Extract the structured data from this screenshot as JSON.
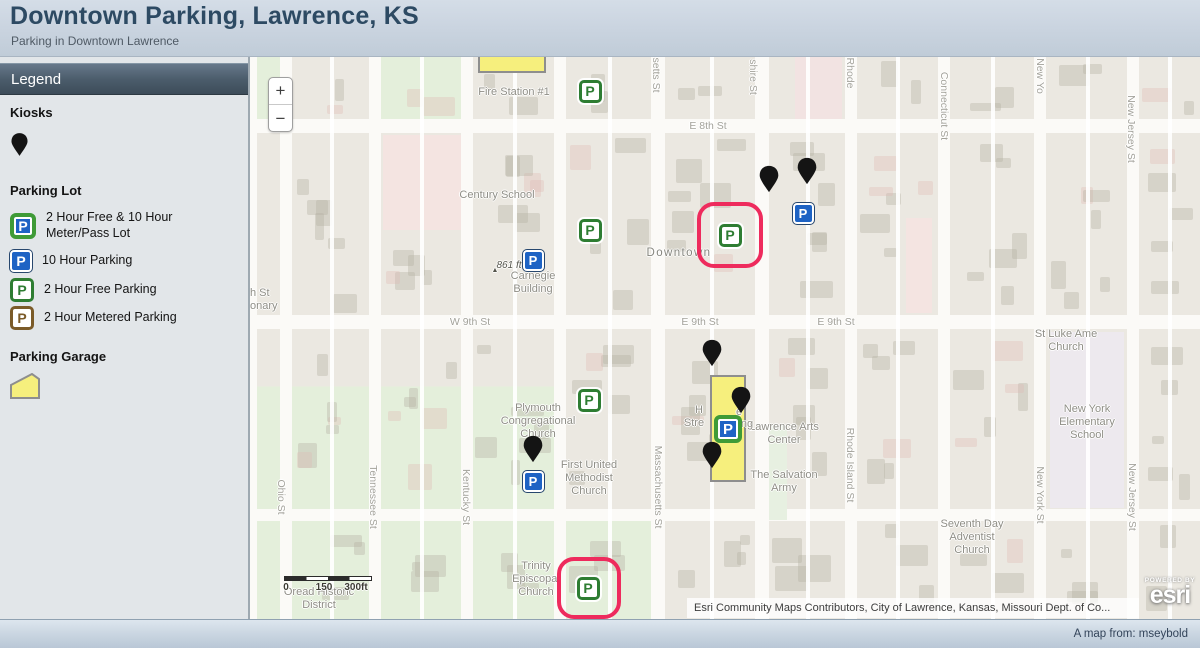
{
  "header": {
    "title": "Downtown Parking, Lawrence, KS",
    "subtitle": "Parking in Downtown Lawrence"
  },
  "legend": {
    "title": "Legend",
    "kiosks_heading": "Kiosks",
    "parking_lot_heading": "Parking Lot",
    "parking_garage_heading": "Parking Garage",
    "items": [
      {
        "icon": "p-green-blue",
        "label": "2 Hour Free & 10 Hour Meter/Pass Lot"
      },
      {
        "icon": "p-blue",
        "label": "10 Hour Parking"
      },
      {
        "icon": "p-green",
        "label": "2 Hour Free Parking"
      },
      {
        "icon": "p-brown",
        "label": "2 Hour Metered Parking"
      }
    ]
  },
  "map": {
    "controls": {
      "zoom_in": "+",
      "zoom_out": "−"
    },
    "scalebar": {
      "labels": [
        "0",
        "150",
        "300ft"
      ]
    },
    "attribution": "Esri Community Maps Contributors, City of Lawrence, Kansas, Missouri Dept. of Co...",
    "logo": {
      "powered_by": "POWERED BY",
      "brand": "esri"
    },
    "poi_labels": [
      {
        "text": "Fire Station #1",
        "x": 264,
        "y": 29
      },
      {
        "text": "Century School",
        "x": 247,
        "y": 132
      },
      {
        "text": "Carnegie\nBuilding",
        "x": 283,
        "y": 213
      },
      {
        "text": "861 ft",
        "x": 259,
        "y": 203,
        "cls": "elev"
      },
      {
        "text": "▲",
        "x": 245,
        "y": 210,
        "cls": "tri"
      },
      {
        "text": "Downtown",
        "x": 429,
        "y": 190,
        "cls": "district"
      },
      {
        "text": "Plymouth\nCongregational\nChurch",
        "x": 288,
        "y": 345
      },
      {
        "text": "First United\nMethodist\nChurch",
        "x": 339,
        "y": 402
      },
      {
        "text": "Lawrence Arts\nCenter",
        "x": 534,
        "y": 364
      },
      {
        "text": "The Salvation\nArmy",
        "x": 534,
        "y": 412
      },
      {
        "text": "Trinity\nEpiscopal\nChurch",
        "x": 286,
        "y": 503
      },
      {
        "text": "Oread Historic\nDistrict",
        "x": 69,
        "y": 529
      },
      {
        "text": "St Luke Ame\nChurch",
        "x": 816,
        "y": 271
      },
      {
        "text": "New York\nElementary\nSchool",
        "x": 837,
        "y": 346
      },
      {
        "text": "Seventh Day\nAdventist\nChurch",
        "x": 722,
        "y": 461
      },
      {
        "text": "H",
        "x": 449,
        "y": 347
      },
      {
        "text": "e",
        "x": 489,
        "y": 349
      },
      {
        "text": "Stre",
        "x": 444,
        "y": 360
      },
      {
        "text": "ng",
        "x": 497,
        "y": 361
      },
      {
        "text": "h St",
        "x": 0,
        "y": 230,
        "cls": "cut"
      },
      {
        "text": "onary",
        "x": 0,
        "y": 243,
        "cls": "cut"
      }
    ],
    "street_labels": [
      {
        "text": "E 8th St",
        "x": 458,
        "y": 69,
        "orient": "h"
      },
      {
        "text": "W 9th St",
        "x": 220,
        "y": 265,
        "orient": "h"
      },
      {
        "text": "E 9th St",
        "x": 450,
        "y": 265,
        "orient": "h"
      },
      {
        "text": "E 9th St",
        "x": 586,
        "y": 265,
        "orient": "h"
      },
      {
        "text": "Ohio St",
        "x": 31,
        "y": 440,
        "orient": "v"
      },
      {
        "text": "Tennessee St",
        "x": 123,
        "y": 440,
        "orient": "v"
      },
      {
        "text": "Kentucky St",
        "x": 216,
        "y": 440,
        "orient": "v"
      },
      {
        "text": "setts St",
        "x": 406,
        "y": 18,
        "orient": "v"
      },
      {
        "text": "Massachusetts St",
        "x": 408,
        "y": 430,
        "orient": "v"
      },
      {
        "text": "shire St",
        "x": 503,
        "y": 20,
        "orient": "v"
      },
      {
        "text": "Rhode",
        "x": 600,
        "y": 16,
        "orient": "v"
      },
      {
        "text": "Rhode Island St",
        "x": 600,
        "y": 408,
        "orient": "v"
      },
      {
        "text": "Connecticut St",
        "x": 694,
        "y": 49,
        "orient": "v"
      },
      {
        "text": "New Yo",
        "x": 790,
        "y": 19,
        "orient": "v"
      },
      {
        "text": "New York St",
        "x": 790,
        "y": 438,
        "orient": "v"
      },
      {
        "text": "New Jersey St",
        "x": 881,
        "y": 72,
        "orient": "v"
      },
      {
        "text": "New Jersey St",
        "x": 882,
        "y": 440,
        "orient": "v"
      }
    ],
    "markers": [
      {
        "type": "p-green",
        "x": 340,
        "y": 34
      },
      {
        "type": "p-green",
        "x": 340,
        "y": 173
      },
      {
        "type": "p-green",
        "x": 339,
        "y": 343
      },
      {
        "type": "p-green",
        "x": 480,
        "y": 178
      },
      {
        "type": "p-green",
        "x": 338,
        "y": 531
      },
      {
        "type": "p-blue",
        "x": 283,
        "y": 203
      },
      {
        "type": "p-blue",
        "x": 553,
        "y": 156
      },
      {
        "type": "p-blue",
        "x": 283,
        "y": 424
      },
      {
        "type": "p-green-blue",
        "x": 478,
        "y": 372
      },
      {
        "type": "kiosk",
        "x": 519,
        "y": 119
      },
      {
        "type": "kiosk",
        "x": 557,
        "y": 111
      },
      {
        "type": "kiosk",
        "x": 462,
        "y": 293
      },
      {
        "type": "kiosk",
        "x": 491,
        "y": 340
      },
      {
        "type": "kiosk",
        "x": 462,
        "y": 395
      },
      {
        "type": "kiosk",
        "x": 283,
        "y": 389
      }
    ],
    "highlights": [
      {
        "x": 447,
        "y": 145,
        "w": 66,
        "h": 66
      },
      {
        "x": 307,
        "y": 500,
        "w": 64,
        "h": 62
      }
    ],
    "garages": [
      {
        "x": 228,
        "y": -2,
        "w": 68,
        "h": 18
      },
      {
        "x": 460,
        "y": 318,
        "w": 36,
        "h": 107
      }
    ]
  },
  "footer": {
    "credit": "A map from: mseybold"
  },
  "colors": {
    "highlight_red": "#ee2b5d",
    "parking_green": "#2e7d32",
    "parking_blue": "#1e63c4",
    "parking_brown": "#7b5b29",
    "garage_yellow": "#f6ef7d",
    "kiosk_black": "#141414"
  }
}
